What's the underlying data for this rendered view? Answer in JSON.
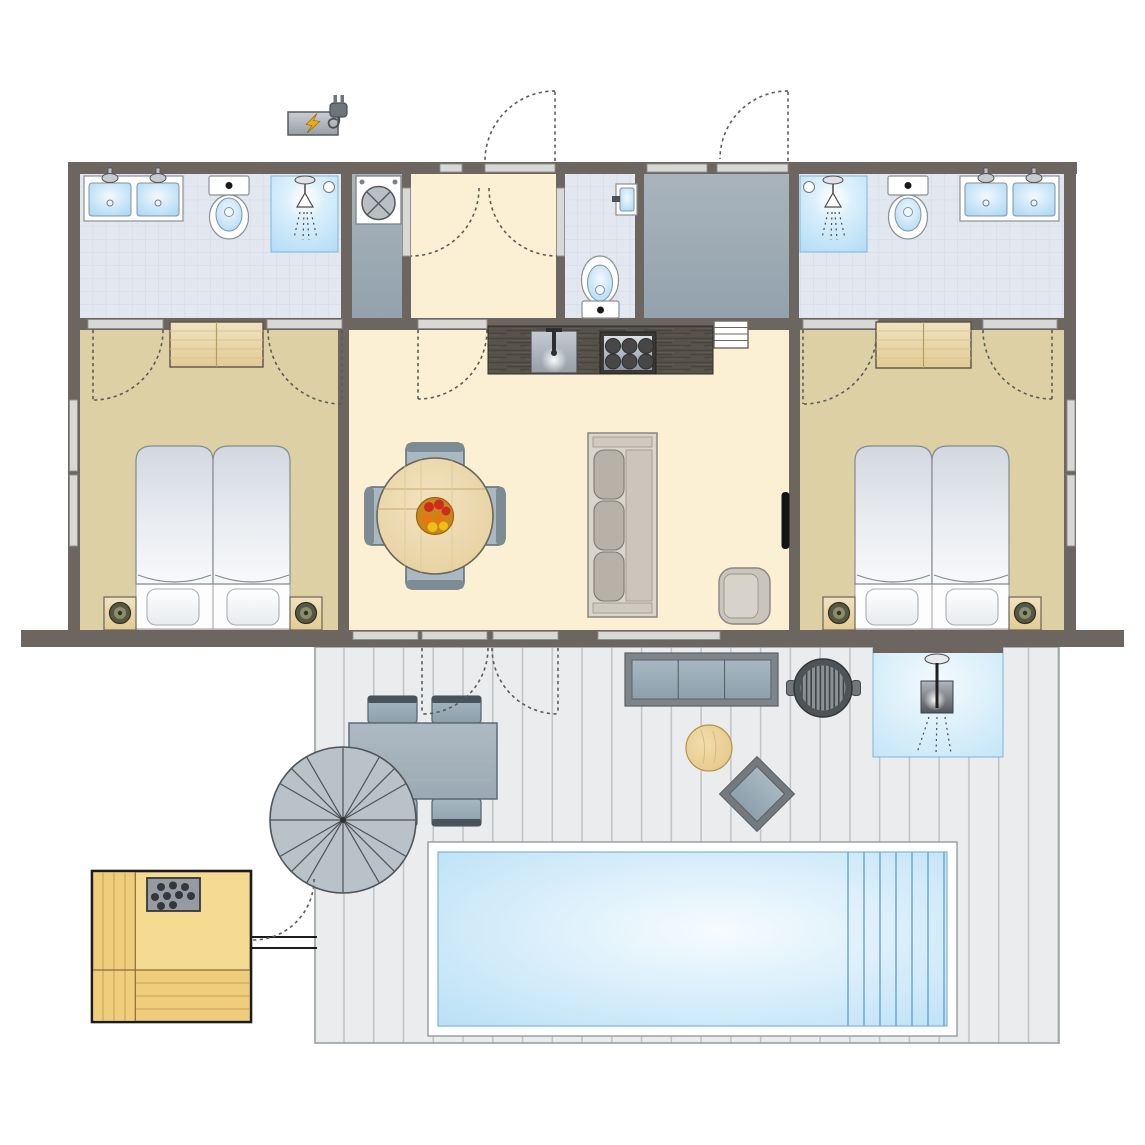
{
  "diagram": {
    "type": "floor-plan",
    "title": "Holiday lodge floor plan with terrace, swimming pool and sauna",
    "palette": {
      "wall": "#6d6560",
      "threshold": "#d8d8d6",
      "tile": "#e3e8f0",
      "tile_line": "#d0d9e6",
      "floor_cream": "#fbf0d3",
      "floor_tan": "#ddd0a4",
      "floor_gray": "#a4b0ba",
      "deck": "#eaecee",
      "deck_line": "#c0c4c7",
      "water": "#bce1f6",
      "water_light": "#f6fbfe",
      "wood_light": "#ecd9b0",
      "wood_sauna": "#f5da92",
      "counter_dark": "#57524b",
      "furniture_gray": "#a9b8c2",
      "furniture_dark": "#5d6b74",
      "sofa_beige": "#d9d5cc",
      "accent_bolt": "#f2a90c",
      "arc": "#5b5b5b"
    },
    "rooms": [
      {
        "id": "bathroom-left",
        "label": "Bathroom (left)",
        "floor": "blue tile",
        "fixtures": [
          "double washbasin",
          "toilet",
          "shower"
        ]
      },
      {
        "id": "laundry-room",
        "label": "Laundry room",
        "floor": "gray",
        "fixtures": [
          "washing machine"
        ]
      },
      {
        "id": "hallway",
        "label": "Entrance hallway",
        "floor": "cream",
        "fixtures": [
          "front door"
        ]
      },
      {
        "id": "wc",
        "label": "Separate toilet",
        "floor": "blue tile",
        "fixtures": [
          "washbasin",
          "toilet"
        ]
      },
      {
        "id": "storage-room",
        "label": "Storage / utility room",
        "floor": "gray",
        "fixtures": [
          "exterior door"
        ]
      },
      {
        "id": "bathroom-right",
        "label": "Bathroom (right)",
        "floor": "blue tile",
        "fixtures": [
          "shower",
          "toilet",
          "double washbasin"
        ]
      },
      {
        "id": "bedroom-left",
        "label": "Bedroom (left)",
        "floor": "tan",
        "fixtures": [
          "wardrobe",
          "double bed",
          "two nightstands with lamps"
        ]
      },
      {
        "id": "living-kitchen",
        "label": "Living room with open kitchen",
        "floor": "cream",
        "fixtures": [
          "kitchen counter with sink and 6-burner hob",
          "radiator",
          "round dining table with fruit bowl",
          "four dining chairs",
          "three-seat sofa",
          "armchair",
          "wall-mounted TV",
          "double terrace door"
        ]
      },
      {
        "id": "bedroom-right",
        "label": "Bedroom (right)",
        "floor": "tan",
        "fixtures": [
          "wardrobe",
          "double bed",
          "two nightstands with lamps"
        ]
      },
      {
        "id": "deck",
        "label": "Terrace deck",
        "floor": "gray planks",
        "fixtures": [
          "outdoor dining table",
          "three outdoor chairs",
          "parasol",
          "outdoor lounge sofa",
          "round side table",
          "ottoman",
          "barbecue grill",
          "outdoor shower",
          "swimming pool with steps"
        ]
      },
      {
        "id": "sauna",
        "label": "Outdoor sauna",
        "floor": "wood",
        "fixtures": [
          "sauna heater with stones",
          "corner benches",
          "walkway to deck"
        ]
      }
    ],
    "exterior": {
      "ev_charger": "Electric vehicle charging point"
    },
    "counts": {
      "bedrooms": 2,
      "bathrooms": 2,
      "toilets": 3,
      "showers": 3,
      "beds": "2 double"
    }
  }
}
